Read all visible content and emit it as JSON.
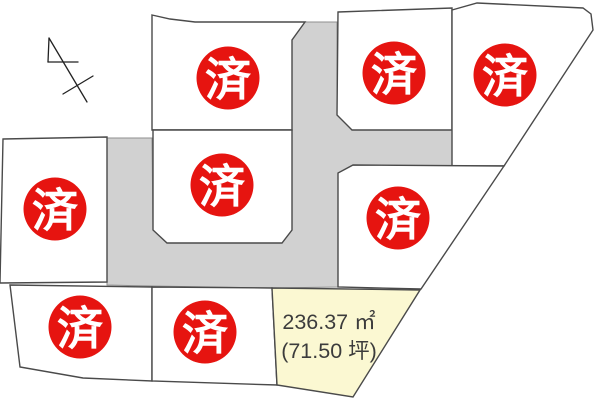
{
  "sold_label": "済",
  "available_plot": {
    "area_m2": "236.37 ㎡",
    "area_tsubo": "(71.50 坪)"
  },
  "colors": {
    "background": "#ffffff",
    "road": "#d1d1d1",
    "road_line": "#8f8f8f",
    "plot_fill": "#ffffff",
    "available_fill": "#fbf8d2",
    "plot_line": "#4a4a4a",
    "sold_red": "#e61410",
    "sold_text": "#ffffff",
    "area_text": "#3c3c3c",
    "arrow_line": "#222222"
  },
  "roads": [
    {
      "id": "road-network",
      "points": [
        [
          305,
          22
        ],
        [
          337,
          22
        ],
        [
          337,
          115
        ],
        [
          352,
          130
        ],
        [
          452,
          130
        ],
        [
          452,
          166
        ],
        [
          353,
          166
        ],
        [
          338,
          173
        ],
        [
          338,
          287
        ],
        [
          272,
          288
        ],
        [
          152,
          286
        ],
        [
          107,
          285
        ],
        [
          107,
          138
        ],
        [
          152,
          138
        ],
        [
          153,
          230
        ],
        [
          167,
          243
        ],
        [
          282,
          243
        ],
        [
          292,
          230
        ],
        [
          292,
          40
        ]
      ]
    }
  ],
  "plots": [
    {
      "id": "top-center",
      "status": "sold",
      "points": [
        [
          152,
          15
        ],
        [
          170,
          19
        ],
        [
          195,
          22
        ],
        [
          305,
          22
        ],
        [
          292,
          40
        ],
        [
          292,
          130
        ],
        [
          152,
          130
        ]
      ],
      "badge": {
        "cx": 228,
        "cy": 78
      }
    },
    {
      "id": "center",
      "status": "sold",
      "points": [
        [
          153,
          130
        ],
        [
          292,
          130
        ],
        [
          292,
          230
        ],
        [
          282,
          243
        ],
        [
          167,
          243
        ],
        [
          153,
          230
        ]
      ],
      "badge": {
        "cx": 222,
        "cy": 185
      }
    },
    {
      "id": "left",
      "status": "sold",
      "points": [
        [
          3,
          139
        ],
        [
          107,
          137
        ],
        [
          107,
          282
        ],
        [
          0,
          283
        ]
      ],
      "badge": {
        "cx": 55,
        "cy": 209
      }
    },
    {
      "id": "top-right",
      "status": "sold",
      "points": [
        [
          338,
          12
        ],
        [
          452,
          8
        ],
        [
          452,
          130
        ],
        [
          352,
          130
        ],
        [
          337,
          115
        ]
      ],
      "badge": {
        "cx": 394,
        "cy": 73
      }
    },
    {
      "id": "far-right",
      "status": "sold",
      "points": [
        [
          452,
          10
        ],
        [
          477,
          3
        ],
        [
          583,
          8
        ],
        [
          591,
          14
        ],
        [
          593,
          30
        ],
        [
          504,
          166
        ],
        [
          452,
          166
        ]
      ],
      "badge": {
        "cx": 505,
        "cy": 75
      }
    },
    {
      "id": "right-middle",
      "status": "sold",
      "points": [
        [
          353,
          165
        ],
        [
          504,
          166
        ],
        [
          421,
          289
        ],
        [
          338,
          287
        ],
        [
          338,
          173
        ]
      ],
      "badge": {
        "cx": 398,
        "cy": 218
      }
    },
    {
      "id": "bottom-left",
      "status": "sold",
      "points": [
        [
          10,
          285
        ],
        [
          152,
          287
        ],
        [
          152,
          381
        ],
        [
          83,
          378
        ],
        [
          20,
          367
        ]
      ],
      "badge": {
        "cx": 80,
        "cy": 327
      }
    },
    {
      "id": "bottom-middle",
      "status": "sold",
      "points": [
        [
          152,
          287
        ],
        [
          272,
          288
        ],
        [
          277,
          385
        ],
        [
          152,
          381
        ]
      ],
      "badge": {
        "cx": 205,
        "cy": 332
      }
    },
    {
      "id": "available",
      "status": "available",
      "points": [
        [
          272,
          288
        ],
        [
          420,
          290
        ],
        [
          353,
          397
        ],
        [
          277,
          385
        ]
      ],
      "badge": null
    }
  ],
  "badge_radius": 31.5,
  "north_arrow": {
    "lines": [
      [
        49,
        38,
        87,
        102
      ],
      [
        49,
        38,
        48,
        62
      ],
      [
        48,
        62,
        78,
        62
      ],
      [
        63,
        94,
        93,
        76
      ]
    ]
  }
}
